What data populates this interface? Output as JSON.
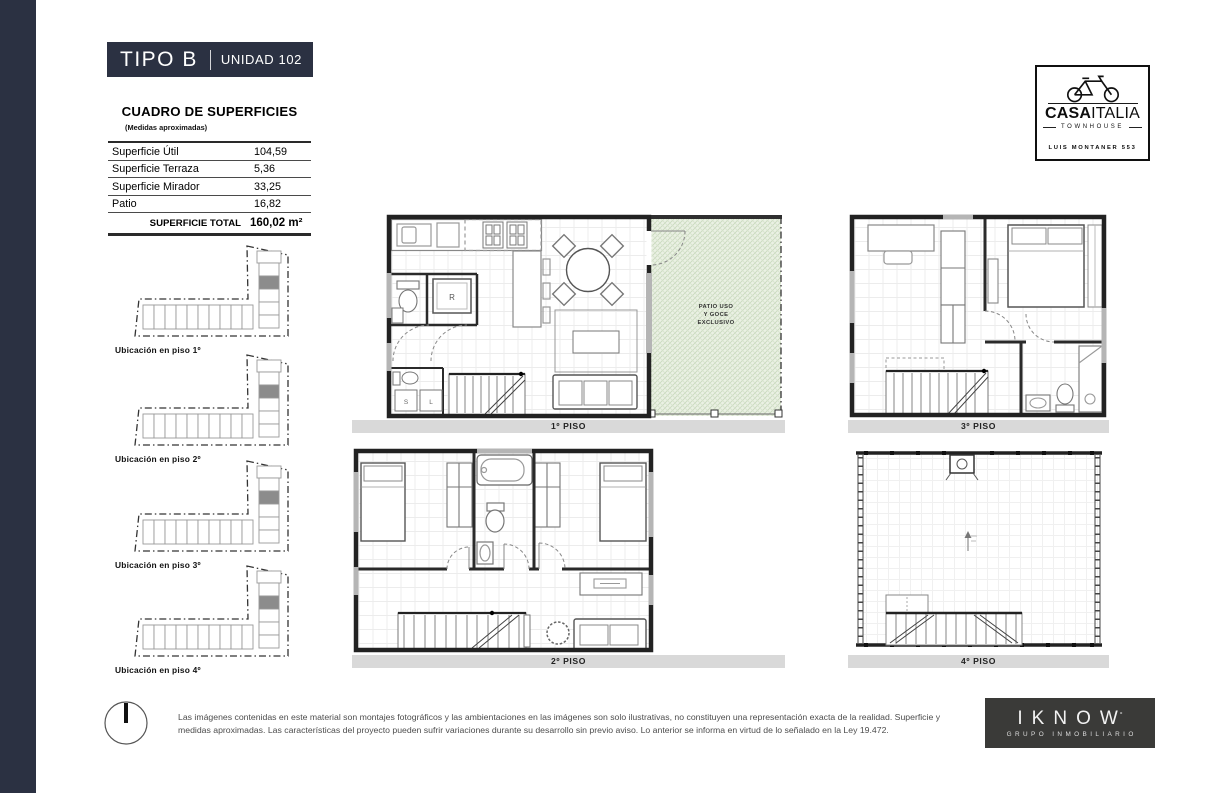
{
  "colors": {
    "accent_navy": "#2b3142",
    "plan_label_bar": "#d9d9d9",
    "patio_green": "#ebf1e4",
    "developer_bg": "#3a3a38",
    "highlight_unit_gray": "#8c8c8c"
  },
  "header": {
    "type_label": "TIPO B",
    "unit_label": "UNIDAD 102"
  },
  "brand": {
    "name_primary": "CASA",
    "name_secondary": "ITALIA",
    "tagline": "TOWNHOUSE",
    "address": "LUIS MONTANER 553"
  },
  "surface_table": {
    "title": "CUADRO DE SUPERFICIES",
    "subtitle": "(Medidas aproximadas)",
    "rows": [
      {
        "label": "Superficie Útil",
        "value": "104,59"
      },
      {
        "label": "Superficie Terraza",
        "value": "5,36"
      },
      {
        "label": "Superficie Mirador",
        "value": "33,25"
      },
      {
        "label": "Patio",
        "value": "16,82"
      }
    ],
    "total_label": "SUPERFICIE TOTAL",
    "total_value": "160,02 m²"
  },
  "location_diagrams": [
    {
      "label": "Ubicación en piso 1º"
    },
    {
      "label": "Ubicación en piso 2º"
    },
    {
      "label": "Ubicación en piso 3º"
    },
    {
      "label": "Ubicación en piso 4º"
    }
  ],
  "plans": {
    "piso1": {
      "label": "1º PISO",
      "fridge": "R",
      "washer": "S",
      "dryer": "L",
      "patio_line1": "PATIO USO",
      "patio_line2": "Y GOCE",
      "patio_line3": "EXCLUSIVO"
    },
    "piso2": {
      "label": "2º PISO"
    },
    "piso3": {
      "label": "3º PISO"
    },
    "piso4": {
      "label": "4º PISO"
    }
  },
  "footer": {
    "disclaimer": "Las imágenes contenidas en este material son montajes fotográficos y las ambientaciones en las imágenes son solo ilustrativas, no constituyen una representación exacta de la realidad. Superficie y medidas aproximadas. Las características del proyecto pueden sufrir variaciones durante su desarrollo sin previo aviso. Lo anterior se informa en virtud de lo señalado en la Ley 19.472."
  },
  "developer": {
    "name": "IKNOW",
    "mark": "°",
    "subtitle": "GRUPO INMOBILIARIO"
  }
}
